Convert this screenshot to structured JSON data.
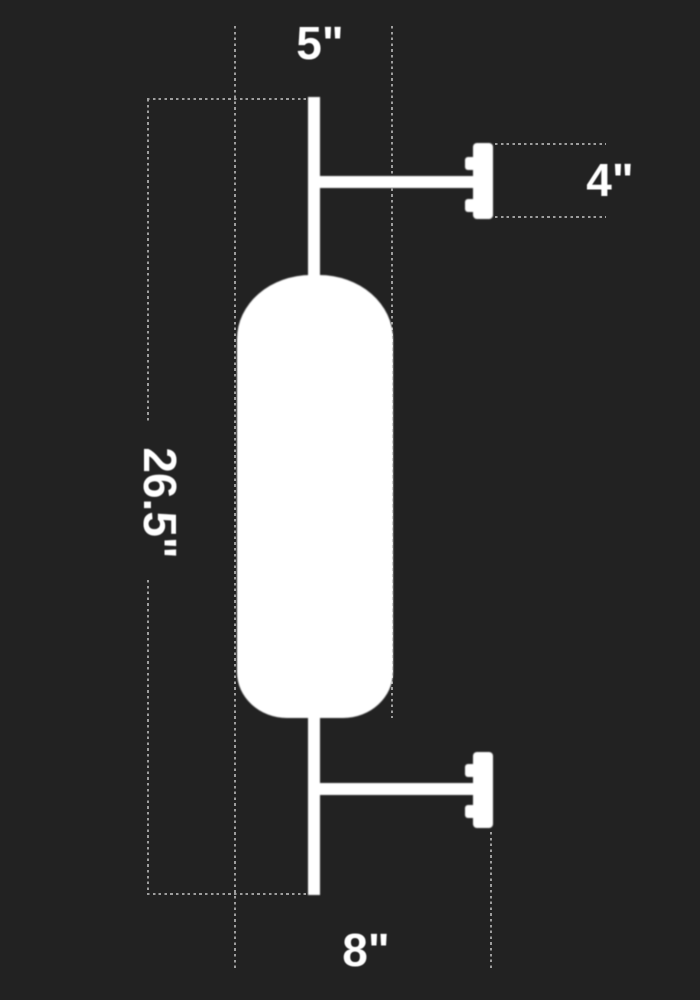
{
  "diagram": {
    "dimensions": {
      "top": "5\"",
      "right": "4\"",
      "left": "26.5\"",
      "bottom": "8\""
    },
    "colors": {
      "background": "#222222",
      "fixture": "#ffffff",
      "dotted_lines": "#9e9e9e",
      "labels": "#ffffff"
    }
  }
}
